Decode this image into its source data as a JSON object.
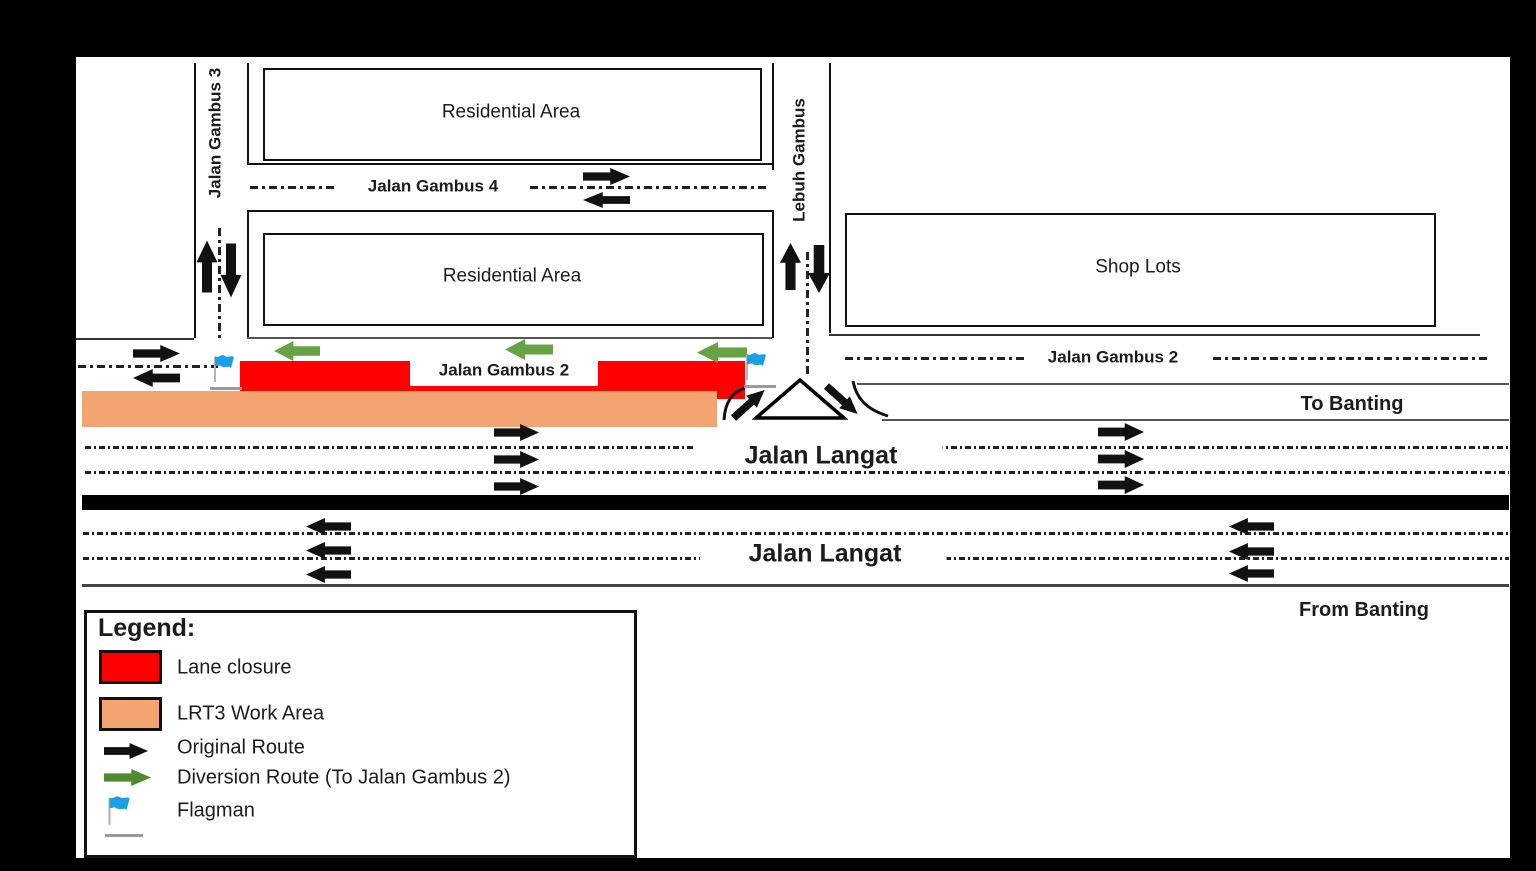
{
  "map": {
    "areas": {
      "residential_1": "Residential Area",
      "residential_2": "Residential Area",
      "shop_lots": "Shop Lots"
    },
    "roads": {
      "jalan_gambus_3": "Jalan Gambus 3",
      "jalan_gambus_4": "Jalan Gambus 4",
      "lebuh_gambus": "Lebuh Gambus",
      "jalan_gambus_2_west": "Jalan Gambus 2",
      "jalan_gambus_2_east": "Jalan Gambus 2",
      "jalan_langat_eastbound": "Jalan Langat",
      "jalan_langat_westbound": "Jalan Langat"
    },
    "directions": {
      "to_banting": "To Banting",
      "from_banting": "From Banting"
    },
    "colors": {
      "lane_closure": "#FF0000",
      "lrt3_work_area": "#F2A471",
      "original_route": "#111111",
      "diversion_route": "#67A345",
      "flagman_flag": "#1C9FE5"
    }
  },
  "legend": {
    "title": "Legend:",
    "items": [
      {
        "id": "lane-closure",
        "label": "Lane closure"
      },
      {
        "id": "lrt3-work-area",
        "label": "LRT3 Work Area"
      },
      {
        "id": "original-route",
        "label": "Original Route"
      },
      {
        "id": "diversion-route",
        "label": "Diversion Route (To Jalan Gambus 2)"
      },
      {
        "id": "flagman",
        "label": "Flagman"
      }
    ]
  }
}
